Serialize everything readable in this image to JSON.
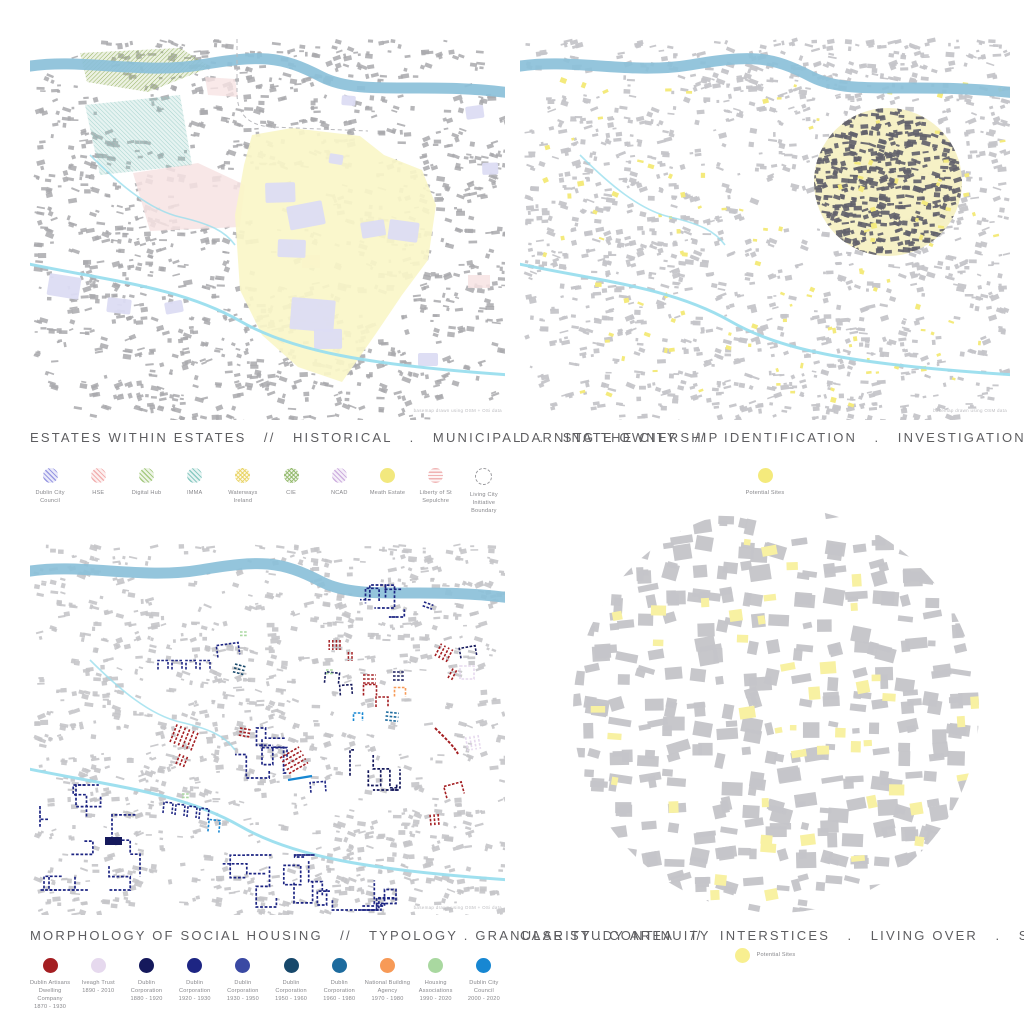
{
  "poster": {
    "background": "#FFFFFF"
  },
  "colors": {
    "title_text": "#5D5D60",
    "legend_text": "#87878B",
    "caption_text": "#BDBDC1",
    "river": "#8BC0D9",
    "canal": "#9ADEEE",
    "fabric_grey": "#A9A9AD",
    "fabric_light": "#C5C5C9",
    "fabric_dark": "#62626B",
    "estate_yellow": "#FAF6C8",
    "hospital_pink": "#F7E3E3",
    "council_lavender": "#DCDCF3",
    "rail_green": "#94B25E",
    "park_teal": "#8CC8C0",
    "site_yellow": "#F4EA7C",
    "circle_yellow": "#F6F0C4",
    "case_site_yellow": "#F8F1A2"
  },
  "panels": {
    "estates": {
      "title": "ESTATES WITHIN ESTATES   //   HISTORICAL   .   MUNICIPAL   .   STATE OWNERSHIP",
      "caption": "basemap drawn using OSM + OSi data",
      "legend": [
        {
          "label": "Dublin City Council",
          "swatch": "hatch45",
          "color": "#8E8EE0"
        },
        {
          "label": "HSE",
          "swatch": "hatch45",
          "color": "#F0A8A8"
        },
        {
          "label": "Digital Hub",
          "swatch": "hatch45",
          "color": "#9CC474"
        },
        {
          "label": "IMMA",
          "swatch": "hatch45",
          "color": "#7EC4BC"
        },
        {
          "label": "Waterways Ireland",
          "swatch": "hatchX",
          "color": "#E8D25E"
        },
        {
          "label": "CIE",
          "swatch": "hatchX",
          "color": "#8DB564"
        },
        {
          "label": "NCAD",
          "swatch": "hatch45",
          "color": "#C9A8DC"
        },
        {
          "label": "Meath Estate",
          "swatch": "solid",
          "color": "#F2E87E"
        },
        {
          "label": "Liberty of St Sepulchre",
          "swatch": "stripes",
          "color": "#F0B4B4"
        },
        {
          "label": "Living City Initiative Boundary",
          "swatch": "outline",
          "color": "#9A9A9E"
        }
      ]
    },
    "darning": {
      "title": "DARNING THE CITY   //   IDENTIFICATION   .   INVESTIGATION   .   PROPOSITION",
      "caption": "basemap drawn using OSM data",
      "legend_label": "Potential Sites",
      "legend_color": "#F4EA7C"
    },
    "morphology": {
      "title": "MORPHOLOGY OF SOCIAL HOUSING   //   TYPOLOGY . GRANULARITY . CONTINUITY",
      "caption": "basemap drawn using OSM + OSi data",
      "legend": [
        {
          "label": "Dublin Artisans Dwelling Company",
          "dates": "1870 - 1930",
          "color": "#A41E22"
        },
        {
          "label": "Iveagh Trust",
          "dates": "1890 - 2010",
          "color": "#E6D9EE"
        },
        {
          "label": "Dublin Corporation",
          "dates": "1880 - 1920",
          "color": "#15195C"
        },
        {
          "label": "Dublin Corporation",
          "dates": "1920 - 1930",
          "color": "#1D2583"
        },
        {
          "label": "Dublin Corporation",
          "dates": "1930 - 1950",
          "color": "#3A49A3"
        },
        {
          "label": "Dublin Corporation",
          "dates": "1950 - 1960",
          "color": "#17486B"
        },
        {
          "label": "Dublin Corporation",
          "dates": "1960 - 1980",
          "color": "#1D6B9E"
        },
        {
          "label": "National Building Agency",
          "dates": "1970 - 1980",
          "color": "#F79A57"
        },
        {
          "label": "Housing Associations",
          "dates": "1990 - 2020",
          "color": "#A9D8A0"
        },
        {
          "label": "Dublin City Council",
          "dates": "2000 - 2020",
          "color": "#1787D2"
        }
      ]
    },
    "casestudy": {
      "title": "CASE STUDY AREA   //   INTERSTICES   .   LIVING OVER   .   STITCHING ON",
      "legend_label": "Potential Sites",
      "legend_color": "#F8EF90"
    }
  }
}
